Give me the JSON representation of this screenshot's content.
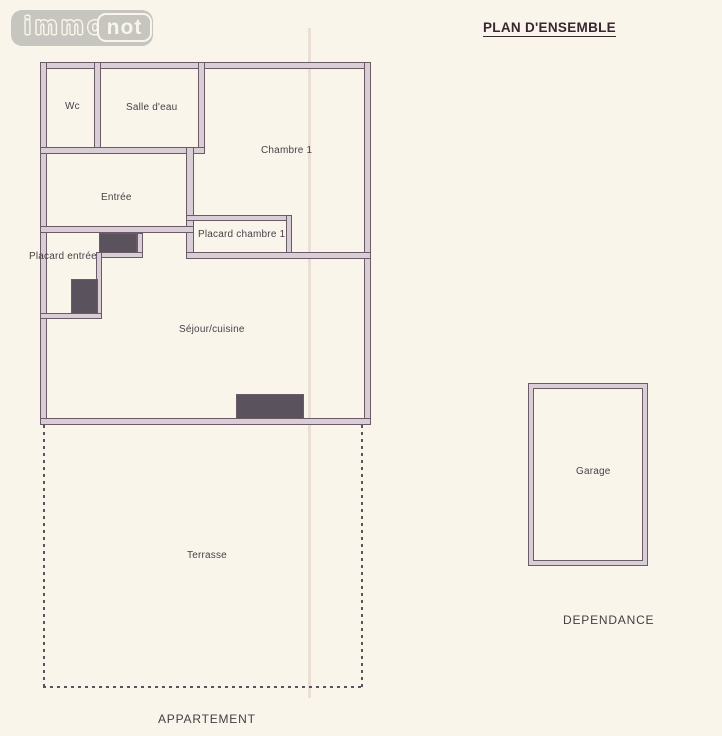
{
  "logo": {
    "part1": "immo",
    "part2": "not"
  },
  "title": "PLAN D'ENSEMBLE",
  "plan": {
    "apartment": {
      "section_label": "APPARTEMENT",
      "rooms": {
        "wc": "Wc",
        "salle_deau": "Salle d'eau",
        "chambre1": "Chambre 1",
        "entree": "Entrée",
        "placard_chambre1": "Placard chambre 1",
        "placard_entree": "Placard entrée",
        "sejour_cuisine": "Séjour/cuisine",
        "terrasse": "Terrasse"
      }
    },
    "dependance": {
      "section_label": "DEPENDANCE",
      "rooms": {
        "garage": "Garage"
      }
    }
  },
  "colors": {
    "paper": "#faf5eb",
    "wall_stroke": "#6b5b67",
    "wall_fill": "#d9cdd6",
    "closet_fill": "#5a535e",
    "label_text": "#4a4149",
    "title_text": "#362730",
    "logo_gray": "#c7c5c0"
  }
}
